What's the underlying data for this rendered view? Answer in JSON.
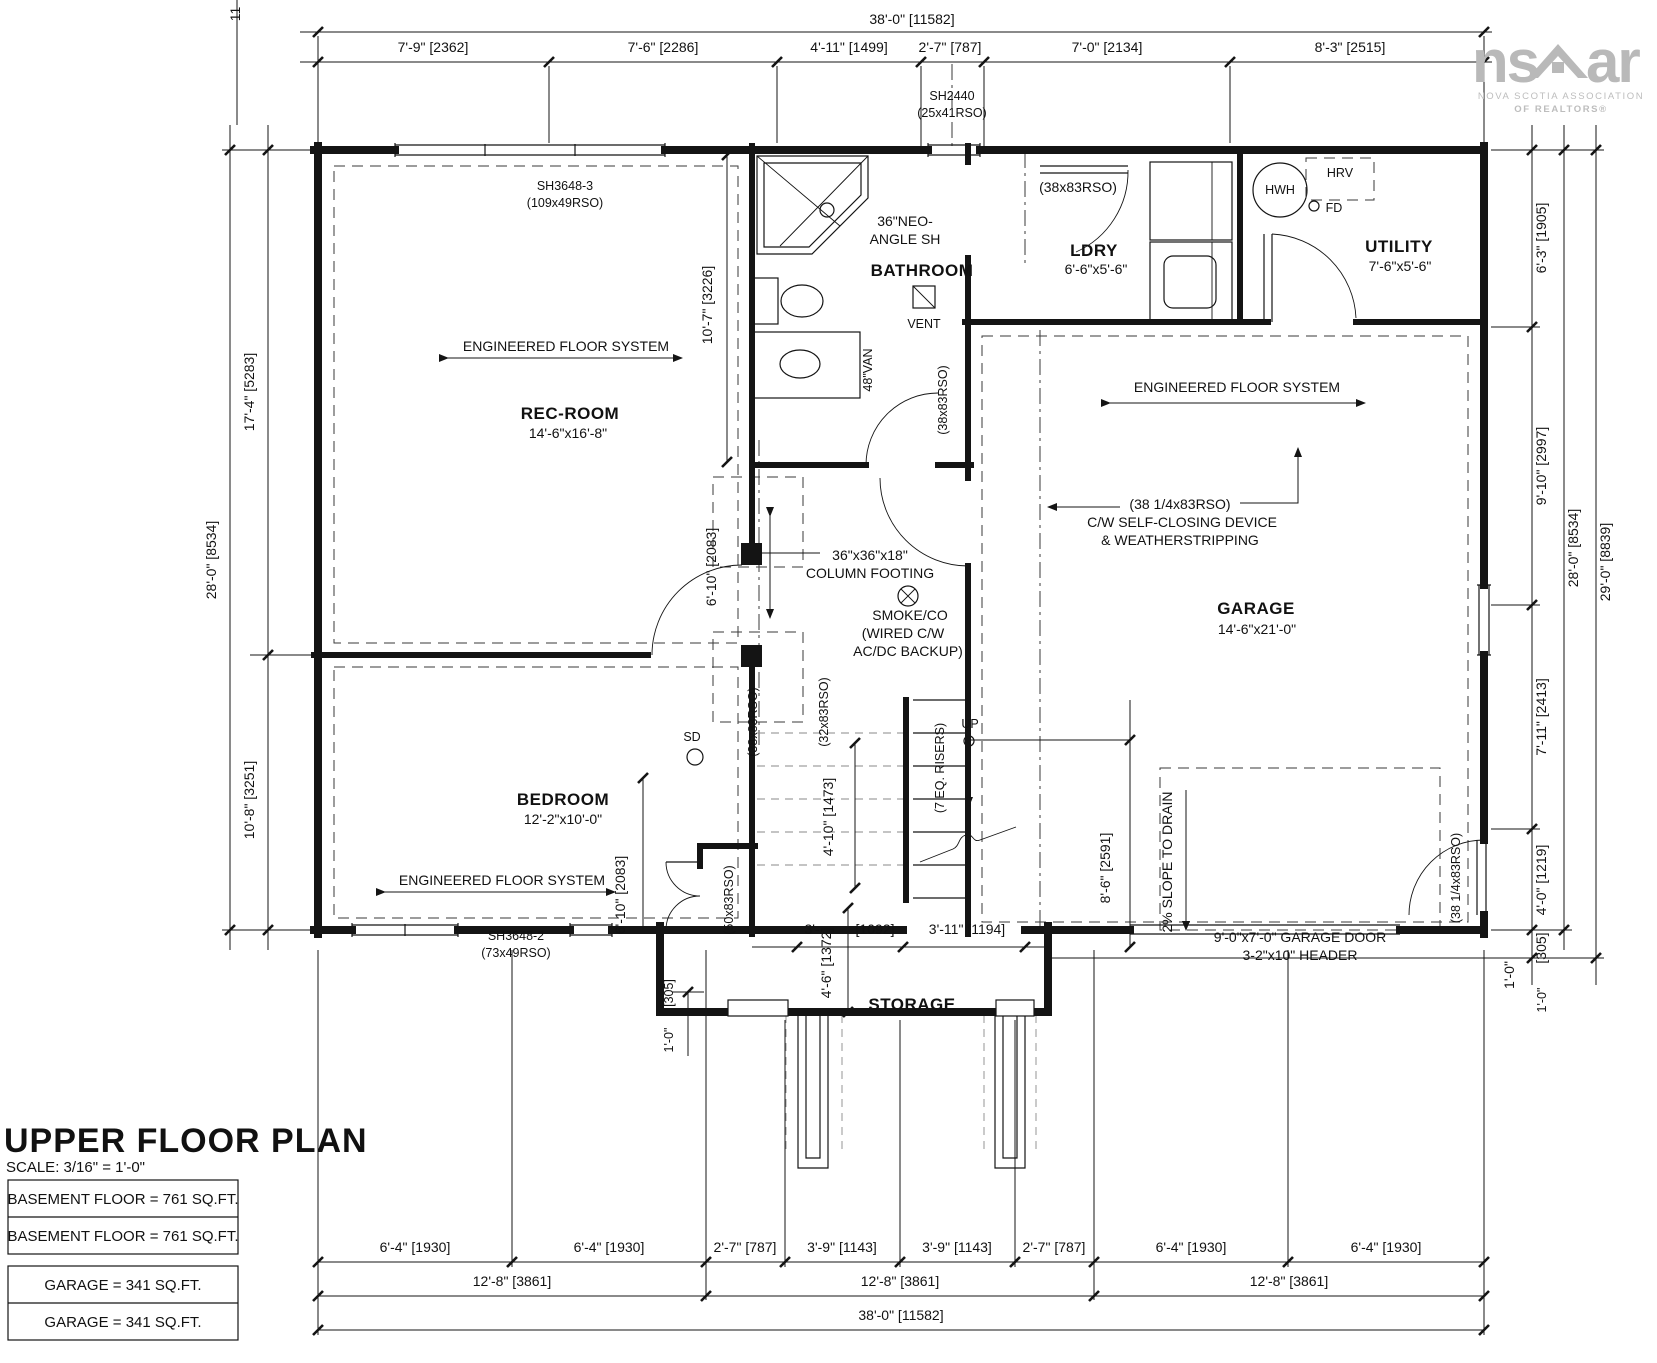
{
  "logo": {
    "brand_left": "ns",
    "brand_right": "ar",
    "assoc_line1": "NOVA SCOTIA ASSOCIATION",
    "assoc_line2": "OF REALTORS®"
  },
  "title_block": {
    "title": "UPPER FLOOR PLAN",
    "scale": "SCALE: 3/16\" = 1'-0\"",
    "basement_area_1": "BASEMENT FLOOR = 761 SQ.FT.",
    "basement_area_2": "BASEMENT FLOOR = 761 SQ.FT.",
    "garage_area_1": "GARAGE = 341 SQ.FT.",
    "garage_area_2": "GARAGE = 341 SQ.FT."
  },
  "rooms": {
    "rec": {
      "name": "REC-ROOM",
      "size": "14'-6\"x16'-8\""
    },
    "bathroom": {
      "name": "BATHROOM"
    },
    "ldry": {
      "name": "LDRY",
      "size": "6'-6\"x5'-6\""
    },
    "utility": {
      "name": "UTILITY",
      "size": "7'-6\"x5'-6\""
    },
    "garage": {
      "name": "GARAGE",
      "size": "14'-6\"x21'-0\""
    },
    "bedroom": {
      "name": "BEDROOM",
      "size": "12'-2\"x10'-0\""
    },
    "storage": {
      "name": "STORAGE"
    }
  },
  "windows": {
    "w1": "SH3648-3",
    "w1_rso": "(109x49RSO)",
    "w2": "SH2440",
    "w2_rso": "(25x41RSO)",
    "w3": "SH3648-2",
    "w3_rso": "(73x49RSO)"
  },
  "doors": {
    "rso38": "(38x83RSO)",
    "rso32": "(32x83RSO)",
    "rso50": "(50x83RSO)",
    "rso38q": "(38 1/4x83RSO)",
    "self_close": "C/W SELF-CLOSING DEVICE",
    "weather": "& WEATHERSTRIPPING",
    "garage_door": "9'-0\"x7'-0\" GARAGE DOOR",
    "garage_header": "3-2\"x10\" HEADER"
  },
  "annotations": {
    "efs": "ENGINEERED FLOOR SYSTEM",
    "shower_1": "36\"NEO-",
    "shower_2": "ANGLE SH",
    "vent": "VENT",
    "vanity": "48\"VAN",
    "hwh": "HWH",
    "hrv": "HRV",
    "fd": "FD",
    "sd": "SD",
    "up": "UP",
    "risers": "(7 EQ. RISERS)",
    "footing_1": "36\"x36\"x18\"",
    "footing_2": "COLUMN FOOTING",
    "smoke_1": "SMOKE/CO",
    "smoke_2": "(WIRED C/W",
    "smoke_3": "AC/DC BACKUP)",
    "slope": "2% SLOPE TO DRAIN"
  },
  "dims": {
    "top_overall": "38'-0\" [11582]",
    "top_segments": [
      "7'-9\" [2362]",
      "7'-6\" [2286]",
      "4'-11\" [1499]",
      "2'-7\" [787]",
      "7'-0\" [2134]",
      "8'-3\" [2515]"
    ],
    "top_cut": "11",
    "left_top": "17'-4\" [5283]",
    "left_overall": "28'-0\" [8534]",
    "left_bottom": "10'-8\" [3251]",
    "right_segments": [
      "6'-3\" [1905]",
      "9'-10\" [2997]",
      "7'-11\" [2413]",
      "4'-0\" [1219]",
      "[305]",
      "1'-0\""
    ],
    "right_overall": "28'-0\" [8534]",
    "right_outer": "29'-0\" [8839]",
    "bottom_row1": [
      "6'-4\" [1930]",
      "6'-4\" [1930]",
      "2'-7\" [787]",
      "3'-9\" [1143]",
      "3'-9\" [1143]",
      "2'-7\" [787]",
      "6'-4\" [1930]",
      "6'-4\" [1930]"
    ],
    "bottom_row2": [
      "12'-8\" [3861]",
      "12'-8\" [3861]",
      "12'-8\" [3861]"
    ],
    "bottom_overall": "38'-0\" [11582]",
    "hall_upper": "10'-7\" [3226]",
    "hall_mid": "6'-10\" [2083]",
    "closet_v": "6'-10\" [2083]",
    "stair_w": "4'-10\" [1473]",
    "storage_left_ft": "3'-",
    "storage_left_mm": "[1092]",
    "storage_right": "3'-11\" [1194]",
    "storage_depth": "4'-6\" [1372]",
    "offset_ft": "1'-0\"",
    "offset_mm": "[305]",
    "garage_v": "8'-6\" [2591]"
  }
}
